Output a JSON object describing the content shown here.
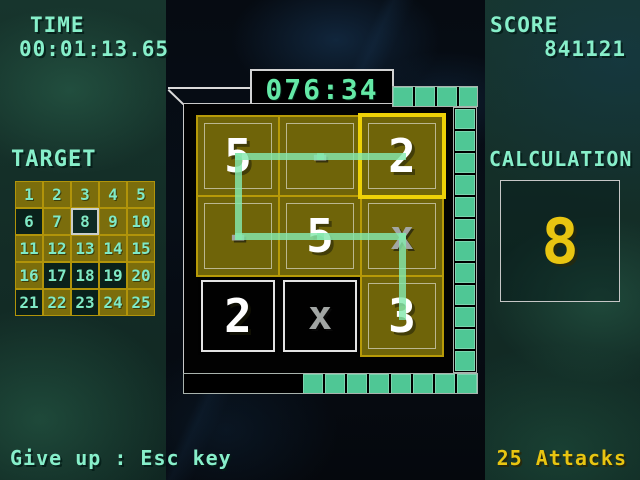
{
  "hud": {
    "time_label": "TIME",
    "time_value": "00:01:13.65",
    "score_label": "SCORE",
    "score_value": "841121",
    "round_timer": "076:34",
    "give_up_hint": "Give up : Esc key",
    "attacks_label": "25 Attacks"
  },
  "target": {
    "label": "TARGET",
    "columns": 5,
    "numbers": [
      1,
      2,
      3,
      4,
      5,
      6,
      7,
      8,
      9,
      10,
      11,
      12,
      13,
      14,
      15,
      16,
      17,
      18,
      19,
      20,
      21,
      22,
      23,
      24,
      25
    ],
    "cleared_numbers": [
      6,
      8,
      17,
      18,
      19,
      21,
      23
    ],
    "highlighted_number": 8
  },
  "board": {
    "cells": [
      {
        "value": "5",
        "kind": "number",
        "state": "open"
      },
      {
        "value": "-",
        "kind": "operator",
        "state": "open"
      },
      {
        "value": "2",
        "kind": "number",
        "state": "cursor"
      },
      {
        "value": "-",
        "kind": "operator",
        "state": "open"
      },
      {
        "value": "5",
        "kind": "number",
        "state": "open"
      },
      {
        "value": "x",
        "kind": "operator",
        "state": "open"
      },
      {
        "value": "2",
        "kind": "number",
        "state": "used"
      },
      {
        "value": "x",
        "kind": "operator",
        "state": "used"
      },
      {
        "value": "3",
        "kind": "number",
        "state": "open"
      }
    ],
    "path_cells": [
      8,
      5,
      4,
      3,
      0,
      1,
      2
    ]
  },
  "calculation": {
    "label": "CALCULATION",
    "value": "8"
  },
  "time_track": {
    "top_segments": 4,
    "right_segments": 12,
    "bottom_segments": 8
  },
  "colors": {
    "mint_text": "#87efca",
    "yellow_text": "#e8c511",
    "tile_gold": "#6f6409",
    "tile_border_yellow": "#b79a08",
    "cursor_yellow": "#eed107",
    "path_green": "#85e9ae",
    "track_green": "#4fc795",
    "used_tile": "#010101"
  }
}
